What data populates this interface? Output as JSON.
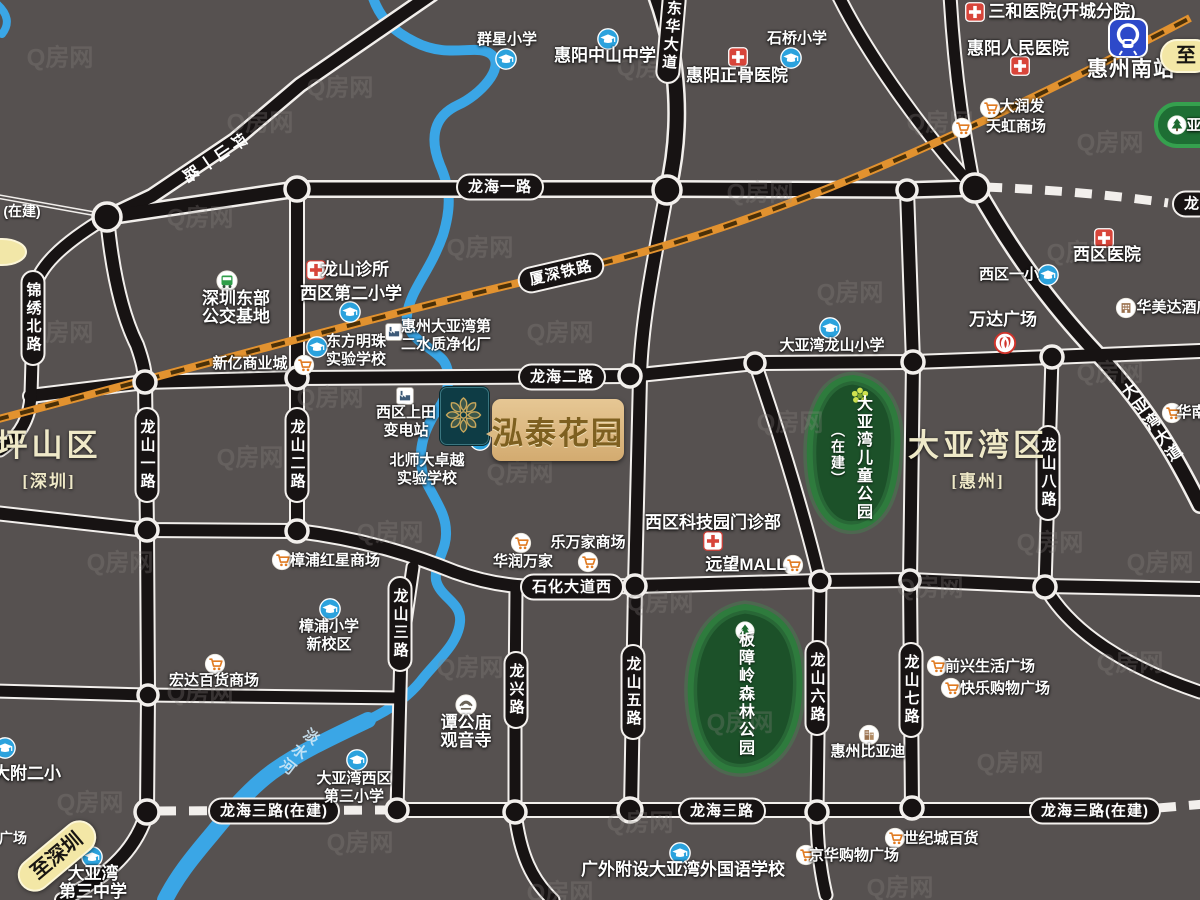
{
  "watermark": "Q房网",
  "project": {
    "name": "泓泰花园"
  },
  "areas": [
    {
      "name": "坪山区",
      "sub": "[深圳]",
      "x": 49,
      "y": 456
    },
    {
      "name": "大亚湾区",
      "sub": "[惠州]",
      "x": 978,
      "y": 456
    }
  ],
  "parks": [
    {
      "name": "大亚湾儿童公园",
      "note": "（在建）",
      "icon": "flower-icon",
      "ix": 860,
      "iy": 396,
      "tx": 862,
      "ty": 458,
      "nx": 838,
      "ny": 455
    },
    {
      "name": "板障岭森林公园",
      "icon": "tree-icon",
      "ix": 745,
      "iy": 631,
      "tx": 744,
      "ty": 694
    },
    {
      "name": "亚",
      "icon": "tree-icon",
      "ix": 1177,
      "iy": 125,
      "tx": 1194,
      "ty": 126,
      "horizontal": true
    }
  ],
  "road_labels": [
    {
      "t": "东华大道",
      "type": "pill-v",
      "x": 671,
      "y": 36,
      "rot": 5
    },
    {
      "t": "龙海一路",
      "type": "pill-h",
      "x": 500,
      "y": 187
    },
    {
      "t": "龙",
      "type": "pill-h",
      "x": 1192,
      "y": 204
    },
    {
      "t": "厦深铁路",
      "type": "pill-h",
      "x": 561,
      "y": 273,
      "rot": -13
    },
    {
      "t": "龙海二路",
      "type": "pill-h",
      "x": 562,
      "y": 377
    },
    {
      "t": "锦绣北路",
      "type": "pill-v",
      "x": 33,
      "y": 318
    },
    {
      "t": "龙山一路",
      "type": "pill-v",
      "x": 147,
      "y": 455
    },
    {
      "t": "龙山二路",
      "type": "pill-v",
      "x": 297,
      "y": 455
    },
    {
      "t": "龙山八路",
      "type": "pill-v",
      "x": 1048,
      "y": 473
    },
    {
      "t": "石化大道西",
      "type": "pill-h",
      "x": 572,
      "y": 587
    },
    {
      "t": "龙山三路",
      "type": "pill-v",
      "x": 400,
      "y": 624
    },
    {
      "t": "龙兴路",
      "type": "pill-v",
      "x": 516,
      "y": 690
    },
    {
      "t": "龙山五路",
      "type": "pill-v",
      "x": 633,
      "y": 692
    },
    {
      "t": "龙山六路",
      "type": "pill-v",
      "x": 817,
      "y": 688
    },
    {
      "t": "龙山七路",
      "type": "pill-v",
      "x": 911,
      "y": 690
    },
    {
      "t": "龙海三路(在建)",
      "type": "pill-h",
      "x": 274,
      "y": 811
    },
    {
      "t": "龙海三路",
      "type": "pill-h",
      "x": 722,
      "y": 811
    },
    {
      "t": "龙海三路(在建)",
      "type": "pill-h",
      "x": 1095,
      "y": 811
    },
    {
      "t": "坪山一路",
      "type": "road-rot",
      "x": 212,
      "y": 156,
      "rot": 56
    },
    {
      "t": "大亚湾大道",
      "type": "road-rot",
      "x": 1150,
      "y": 424,
      "rot": -35
    },
    {
      "t": "淡水河",
      "type": "river-rot",
      "x": 298,
      "y": 752,
      "rot": 38
    }
  ],
  "pois": [
    {
      "t": [
        "群星小学"
      ],
      "x": 507,
      "y": 40,
      "icon": "school-icon",
      "ix": 506,
      "iy": 59
    },
    {
      "t": [
        "惠阳中山中学"
      ],
      "x": 605,
      "y": 56,
      "cls": "big",
      "icon": "school-icon",
      "ix": 608,
      "iy": 39
    },
    {
      "t": [
        "石桥小学"
      ],
      "x": 797,
      "y": 39,
      "icon": "school-icon",
      "ix": 791,
      "iy": 58
    },
    {
      "t": [
        "惠阳正骨医院"
      ],
      "x": 737,
      "y": 76,
      "cls": "big",
      "icon": "hospital-icon",
      "ix": 738,
      "iy": 57
    },
    {
      "t": [
        "三和医院(开城分院)"
      ],
      "x": 1062,
      "y": 12,
      "cls": "big",
      "icon": "hospital-icon",
      "ix": 975,
      "iy": 12
    },
    {
      "t": [
        "惠阳人民医院"
      ],
      "x": 1018,
      "y": 49,
      "cls": "big",
      "icon": "hospital-icon",
      "ix": 1020,
      "iy": 66
    },
    {
      "t": [
        "惠州南站"
      ],
      "x": 1131,
      "y": 70,
      "cls": "station",
      "icon": "railway-station-icon",
      "ix": 1128,
      "iy": 38
    },
    {
      "t": [
        "大润发"
      ],
      "x": 1022,
      "y": 107,
      "icon": "cart-icon",
      "ix": 990,
      "iy": 108
    },
    {
      "t": [
        "天虹商场"
      ],
      "x": 1016,
      "y": 127,
      "icon": "cart-icon",
      "ix": 962,
      "iy": 128
    },
    {
      "t": [
        "深圳东部",
        "公交基地"
      ],
      "x": 236,
      "y": 308,
      "cls": "big",
      "icon": "bus-icon",
      "ix": 227,
      "iy": 281
    },
    {
      "t": [
        "龙山诊所"
      ],
      "x": 355,
      "y": 270,
      "cls": "big",
      "icon": "clinic-icon",
      "ix": 316,
      "iy": 270
    },
    {
      "t": [
        "西区第二小学"
      ],
      "x": 351,
      "y": 294,
      "cls": "big",
      "icon": "school-icon",
      "ix": 350,
      "iy": 312
    },
    {
      "t": [
        "东方明珠",
        "实验学校"
      ],
      "x": 356,
      "y": 351,
      "icon": "school-icon",
      "ix": 317,
      "iy": 347
    },
    {
      "t": [
        "惠州大亚湾第",
        "二水质净化厂"
      ],
      "x": 446,
      "y": 336,
      "icon": "factory-icon",
      "ix": 394,
      "iy": 332
    },
    {
      "t": [
        "新亿商业城"
      ],
      "x": 250,
      "y": 364,
      "icon": "cart-icon",
      "ix": 304,
      "iy": 365
    },
    {
      "t": [
        "西区一小"
      ],
      "x": 1009,
      "y": 275,
      "icon": "school-icon",
      "ix": 1048,
      "iy": 275
    },
    {
      "t": [
        "西区医院"
      ],
      "x": 1107,
      "y": 255,
      "cls": "big",
      "icon": "hospital-icon",
      "ix": 1104,
      "iy": 238
    },
    {
      "t": [
        "华美达酒店"
      ],
      "x": 1174,
      "y": 308,
      "icon": "hotel-icon",
      "ix": 1126,
      "iy": 308
    },
    {
      "t": [
        "大亚湾龙山小学"
      ],
      "x": 832,
      "y": 346,
      "icon": "school-icon",
      "ix": 830,
      "iy": 328
    },
    {
      "t": [
        "万达广场"
      ],
      "x": 1003,
      "y": 320,
      "cls": "big",
      "icon": "wanda-icon",
      "ix": 1005,
      "iy": 343
    },
    {
      "t": [
        "西区上田",
        "变电站"
      ],
      "x": 406,
      "y": 422,
      "icon": "factory-icon",
      "ix": 405,
      "iy": 396
    },
    {
      "t": [
        "北师大卓越",
        "实验学校"
      ],
      "x": 427,
      "y": 470,
      "icon": "school-icon",
      "ix": 480,
      "iy": 440
    },
    {
      "t": [
        "乐万家商场"
      ],
      "x": 588,
      "y": 543,
      "icon": "cart-icon",
      "ix": 588,
      "iy": 562
    },
    {
      "t": [
        "华润万家"
      ],
      "x": 523,
      "y": 562,
      "icon": "cart-icon",
      "ix": 521,
      "iy": 543
    },
    {
      "t": [
        "西区科技园门诊部"
      ],
      "x": 713,
      "y": 523,
      "cls": "big",
      "icon": "clinic-icon",
      "ix": 713,
      "iy": 541
    },
    {
      "t": [
        "远望MALL"
      ],
      "x": 746,
      "y": 565,
      "cls": "big",
      "icon": "cart-icon",
      "ix": 793,
      "iy": 565
    },
    {
      "t": [
        "樟浦红星商场"
      ],
      "x": 335,
      "y": 561,
      "icon": "cart-icon",
      "ix": 282,
      "iy": 560
    },
    {
      "t": [
        "樟浦小学",
        "新校区"
      ],
      "x": 329,
      "y": 636,
      "icon": "school-icon",
      "ix": 330,
      "iy": 609
    },
    {
      "t": [
        "宏达百货商场"
      ],
      "x": 214,
      "y": 681,
      "icon": "cart-icon",
      "ix": 215,
      "iy": 664
    },
    {
      "t": [
        "谭公庙",
        "观音寺"
      ],
      "x": 466,
      "y": 732,
      "cls": "big",
      "icon": "temple-icon",
      "ix": 466,
      "iy": 705
    },
    {
      "t": [
        "大亚湾西区",
        "第三小学"
      ],
      "x": 354,
      "y": 788,
      "icon": "school-icon",
      "ix": 357,
      "iy": 760
    },
    {
      "t": [
        "大附二小"
      ],
      "x": 27,
      "y": 774,
      "cls": "big",
      "icon": "school-icon",
      "ix": 5,
      "iy": 748
    },
    {
      "t": [
        "大亚湾",
        "第三中学"
      ],
      "x": 93,
      "y": 883,
      "cls": "big",
      "icon": "school-icon",
      "ix": 92,
      "iy": 857
    },
    {
      "t": [
        "广外附设大亚湾外国语学校"
      ],
      "x": 683,
      "y": 870,
      "cls": "big",
      "icon": "school-icon",
      "ix": 680,
      "iy": 853
    },
    {
      "t": [
        "世纪城百货"
      ],
      "x": 941,
      "y": 839,
      "icon": "cart-icon",
      "ix": 895,
      "iy": 838
    },
    {
      "t": [
        "京华购物广场"
      ],
      "x": 854,
      "y": 856,
      "icon": "cart-icon",
      "ix": 806,
      "iy": 855
    },
    {
      "t": [
        "前兴生活广场"
      ],
      "x": 990,
      "y": 667,
      "icon": "cart-icon",
      "ix": 937,
      "iy": 666
    },
    {
      "t": [
        "快乐购物广场"
      ],
      "x": 1005,
      "y": 689,
      "icon": "cart-icon",
      "ix": 951,
      "iy": 688
    },
    {
      "t": [
        "惠州比亚迪"
      ],
      "x": 868,
      "y": 752,
      "icon": "building-icon",
      "ix": 869,
      "iy": 735
    },
    {
      "t": [
        "华南城"
      ],
      "x": 1199,
      "y": 413,
      "icon": "cart-icon",
      "ix": 1172,
      "iy": 413
    }
  ],
  "banners": [
    {
      "text": "至深圳",
      "chevron": "《",
      "x": 57,
      "y": 856,
      "rot": -40
    },
    {
      "text": "至",
      "x": 1186,
      "y": 56,
      "rot": 0
    }
  ],
  "fragments": [
    {
      "text": "(在建)",
      "x": 22,
      "y": 211
    },
    {
      "text": "广场",
      "x": 13,
      "y": 838
    }
  ]
}
